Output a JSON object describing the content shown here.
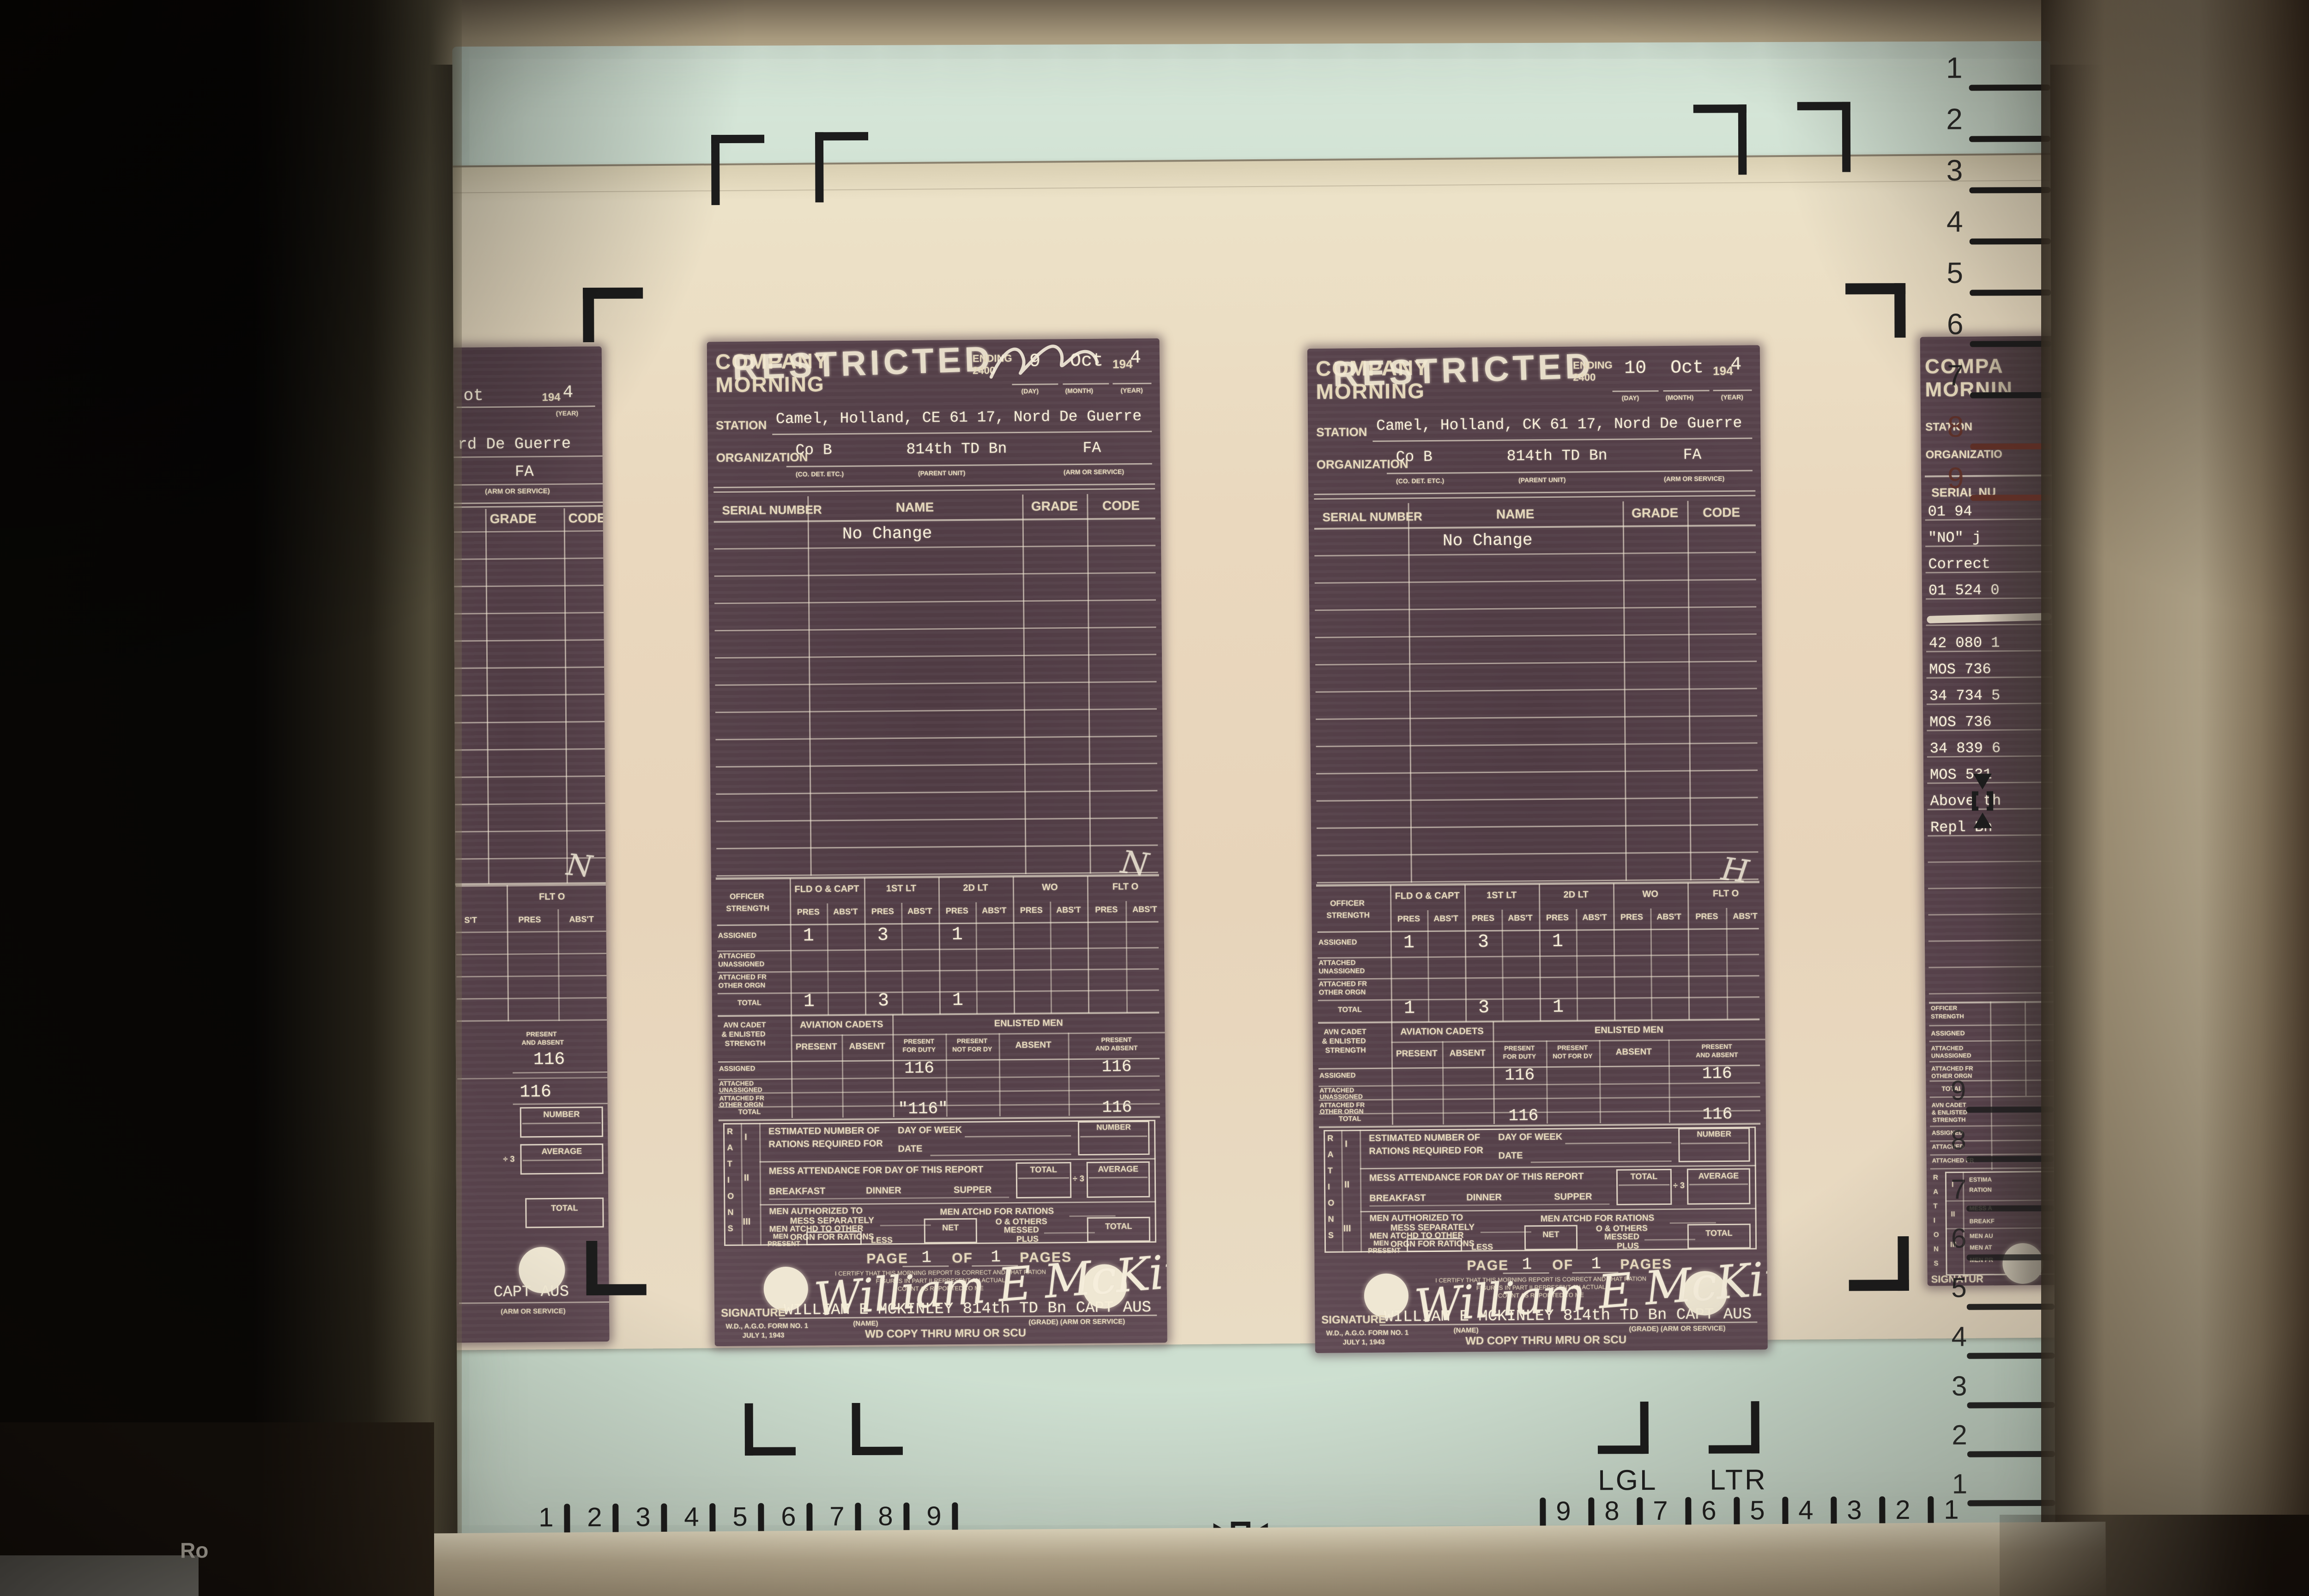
{
  "machine": {
    "housing_label": "Ro"
  },
  "screen": {
    "format_labels": {
      "lgl": "LGL",
      "ltr": "LTR"
    },
    "rulers": {
      "bottom_left": [
        "1",
        "2",
        "3",
        "4",
        "5",
        "6",
        "7",
        "8",
        "9"
      ],
      "bottom_right": [
        "9",
        "8",
        "7",
        "6",
        "5",
        "4",
        "3",
        "2",
        "1"
      ],
      "right_top": [
        "1",
        "2",
        "3",
        "4",
        "5",
        "6",
        "7",
        "8",
        "9"
      ],
      "right_bottom": [
        "9",
        "8",
        "7",
        "6",
        "5",
        "4",
        "3",
        "2",
        "1"
      ]
    }
  },
  "form_labels": {
    "title1": "COMPANY",
    "title2": "MORNING",
    "stamp": "RESTRICTED",
    "ending1": "ENDING",
    "ending2": "2400",
    "year_preprint": "194",
    "sub_day": "(DAY)",
    "sub_month": "(MONTH)",
    "sub_year": "(YEAR)",
    "station": "STATION",
    "organization": "ORGANIZATION",
    "org_sub1": "(CO. DET. ETC.)",
    "org_sub2": "(PARENT UNIT)",
    "org_sub3": "(ARM OR SERVICE)",
    "roster": {
      "serial": "SERIAL NUMBER",
      "name": "NAME",
      "grade": "GRADE",
      "code": "CODE"
    },
    "officer": {
      "corner1": "OFFICER",
      "corner2": "STRENGTH",
      "groups": [
        "FLD O & CAPT",
        "1ST LT",
        "2D LT",
        "WO",
        "FLT O"
      ],
      "pres": "PRES",
      "abst": "ABS'T",
      "row1": "ASSIGNED",
      "row2a": "ATTACHED",
      "row2b": "UNASSIGNED",
      "row3a": "ATTACHED FR",
      "row3b": "OTHER ORGN",
      "row4": "TOTAL"
    },
    "avn": {
      "corner1": "AVN CADET",
      "corner2": "& ENLISTED",
      "corner3": "STRENGTH",
      "group1": "AVIATION CADETS",
      "group2": "ENLISTED MEN",
      "present": "PRESENT",
      "absent": "ABSENT",
      "pfd1": "PRESENT",
      "pfd2": "FOR DUTY",
      "pnfd1": "PRESENT",
      "pnfd2": "NOT FOR DY",
      "pa1": "PRESENT",
      "pa2": "AND ABSENT"
    },
    "rations": {
      "side": "RATIONS",
      "n1": "I",
      "n2": "II",
      "n3": "III",
      "est1": "ESTIMATED NUMBER OF",
      "est2": "RATIONS REQUIRED FOR",
      "dow": "DAY OF WEEK",
      "date": "DATE",
      "number": "NUMBER",
      "mess": "MESS ATTENDANCE FOR DAY OF THIS REPORT",
      "breakfast": "BREAKFAST",
      "dinner": "DINNER",
      "supper": "SUPPER",
      "total": "TOTAL",
      "divide": "÷ 3",
      "average": "AVERAGE",
      "auth1": "MEN AUTHORIZED TO",
      "auth2": "MESS SEPARATELY",
      "atchd_rations": "MEN ATCHD FOR RATIONS",
      "others1": "O & OTHERS",
      "others2": "MESSED",
      "atchd_other1": "MEN ATCHD TO OTHER",
      "atchd_other2": "ORGN FOR RATIONS",
      "net": "NET",
      "men1": "MEN",
      "men2": "PRESENT",
      "less": "LESS",
      "plus": "PLUS"
    },
    "footer": {
      "page": "PAGE",
      "of": "OF",
      "pages": "PAGES",
      "cert1": "I CERTIFY THAT THIS MORNING REPORT IS CORRECT AND THAT RATION",
      "cert2": "FIGURES IN PART II REPRESENT AN ACTUAL",
      "cert3": "COUNT AS REPORTED TO ME",
      "signature": "SIGNATURE",
      "name_sub": "(NAME)",
      "grade_sub": "(GRADE)   (ARM OR SERVICE)",
      "form_no": "W.D., A.G.O. FORM NO. 1",
      "form_date": "JULY 1, 1943",
      "copy": "WD COPY THRU MRU OR SCU"
    }
  },
  "documents": [
    {
      "day": "9",
      "month": "Oct",
      "year": "4",
      "station_value": "Camel, Holland, CE 61 17, Nord De Guerre",
      "org_co": "Co B",
      "org_parent": "814th TD Bn",
      "org_arm": "FA",
      "roster_row1": "No Change",
      "officer_assigned": [
        "1",
        "3",
        "1"
      ],
      "officer_total": [
        "1",
        "3",
        "1"
      ],
      "enl_assigned_pfd": "116",
      "enl_assigned_pa": "116",
      "enl_total_pfd": "\"116\"",
      "enl_total_pa": "116",
      "page": "1",
      "pages": "1",
      "signature_script": "William E McKinley",
      "signature_typed": "WILLIAM E MCKINLEY 814th TD Bn CAPT AUS",
      "hand_mark": "N",
      "day_scribble": true
    },
    {
      "day": "10",
      "month": "Oct",
      "year": "4",
      "station_value": "Camel, Holland, CK 61 17, Nord De Guerre",
      "org_co": "Co B",
      "org_parent": "814th TD Bn",
      "org_arm": "FA",
      "roster_row1": "No Change",
      "officer_assigned": [
        "1",
        "3",
        "1"
      ],
      "officer_total": [
        "1",
        "3",
        "1"
      ],
      "enl_assigned_pfd": "116",
      "enl_assigned_pa": "116",
      "enl_total_pfd": "116",
      "enl_total_pa": "116",
      "page": "1",
      "pages": "1",
      "signature_script": "William E McKinley",
      "signature_typed": "WILLIAM E MCKINLEY 814th TD Bn CAPT AUS",
      "hand_mark": "H",
      "day_scribble": false
    }
  ],
  "left_partial": {
    "date_fragment": "ot",
    "year_preprint": "194",
    "year": "4",
    "sub_year": "(YEAR)",
    "station_fragment": "rd De Guerre",
    "arm": "FA",
    "arm_sub": "(ARM OR SERVICE)",
    "grade": "GRADE",
    "code": "CODE",
    "flt": "FLT O",
    "abst_cut": "S'T",
    "pres": "PRES",
    "abst": "ABS'T",
    "pa1": "PRESENT",
    "pa2": "AND ABSENT",
    "v1": "116",
    "v2": "116",
    "number": "NUMBER",
    "divide": "÷ 3",
    "average": "AVERAGE",
    "total": "TOTAL",
    "sig_fragment": "CAPT AUS",
    "arm_sub2": "(ARM OR SERVICE)",
    "hand_mark": "N"
  },
  "right_partial": {
    "title1": "COMPA",
    "title2": "MORNIN",
    "station": "STATION",
    "organization": "ORGANIZATIO",
    "serial": "SERIAL NU",
    "lines": [
      "01 94",
      "\"NO\" j",
      "Correct",
      "01 524 0",
      "",
      "42 080 1",
      "MOS 736",
      "34 734 5",
      "MOS 736",
      "34 839 6",
      "MOS 531",
      "Above th",
      "Repl Bn"
    ],
    "officer": [
      "OFFICER",
      "STRENGTH",
      "ASSIGNED",
      "ATTACHED",
      "UNASSIGNED",
      "ATTACHED FR",
      "OTHER ORGN",
      "TOTAL"
    ],
    "avn": [
      "AVN CADET",
      "& ENLISTED",
      "STRENGTH",
      "ASSIGNED",
      "ATTACHED",
      "ATTACHED FR"
    ],
    "rations_side": "RATIONS",
    "numerals": [
      "I",
      "II",
      "III"
    ],
    "ration_frags": [
      "ESTIMA",
      "RATION",
      "MESS A",
      "BREAKF",
      "MEN AU",
      "MEN AT",
      "MEN PR"
    ],
    "signature": "SIGNATUR"
  }
}
